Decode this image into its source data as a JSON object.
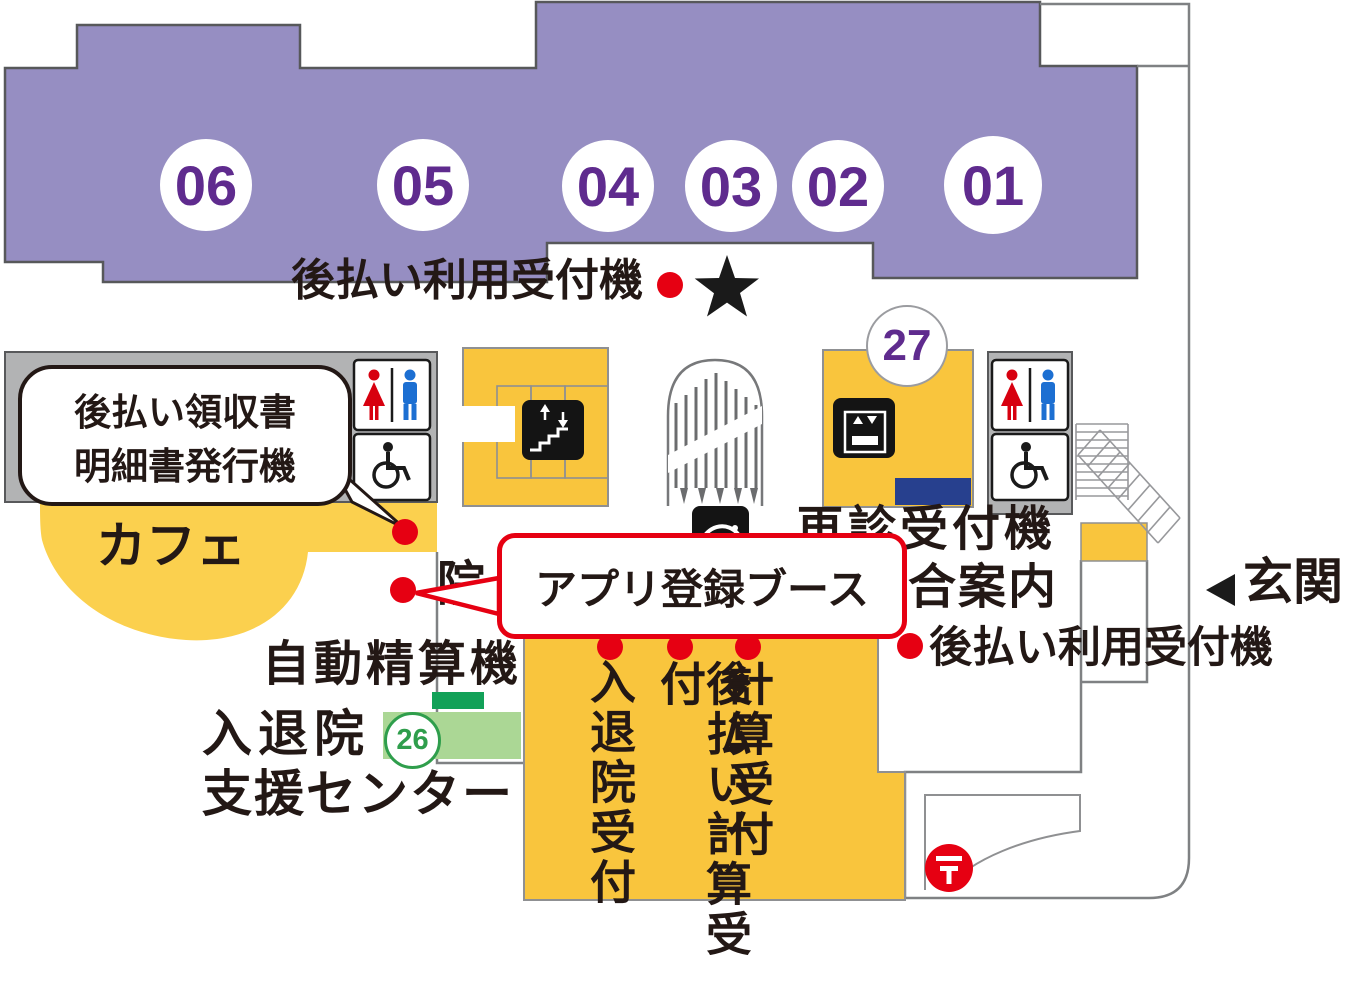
{
  "map_title": "hospital-first-floor-guide-map",
  "wards": [
    "06",
    "05",
    "04",
    "03",
    "02",
    "01"
  ],
  "counters": {
    "reexam_counter": "27",
    "admission_counter": "26"
  },
  "labels": {
    "deferred_payment_reception_top": "後払い利用受付機",
    "deferred_payment_reception_right": "後払い利用受付機",
    "receipt_machine_line1": "後払い領収書",
    "receipt_machine_line2": "明細書発行機",
    "cafe": "カフェ",
    "app_registration_booth": "アプリ登録ブース",
    "partial_hidden_char": "院",
    "reexam_reception_machine": "再診受付機",
    "general_information": "総合案内",
    "entrance": "玄関",
    "auto_payment_machine": "自動精算機",
    "admission_discharge_line1": "入退院",
    "admission_discharge_line2": "支援センター",
    "column_admission_reception": "入退院受付",
    "column_deferred_calc_reception": "後払い計算受付",
    "column_calc_reception": "計算受付",
    "postal_mark": "〒"
  },
  "icons": [
    "female-icon",
    "male-icon",
    "wheelchair-icon",
    "escalator-icon",
    "elevator-icon",
    "service-icon",
    "star-icon",
    "postal-icon",
    "entrance-arrow-icon",
    "location-dot"
  ],
  "colors": {
    "ward_purple": "#968ec2",
    "number_purple": "#5f2b8e",
    "zone_yellow": "#f9c53d",
    "cafe_yellow": "#fbd04e",
    "accent_red": "#e60012",
    "counter_navy": "#27408e",
    "green_dark": "#12a158",
    "green_light": "#abd795",
    "green_badge": "#2f9e4c",
    "gray_block": "#b2b3b4",
    "wall_gray": "#7f8183",
    "text_black": "#231815"
  }
}
